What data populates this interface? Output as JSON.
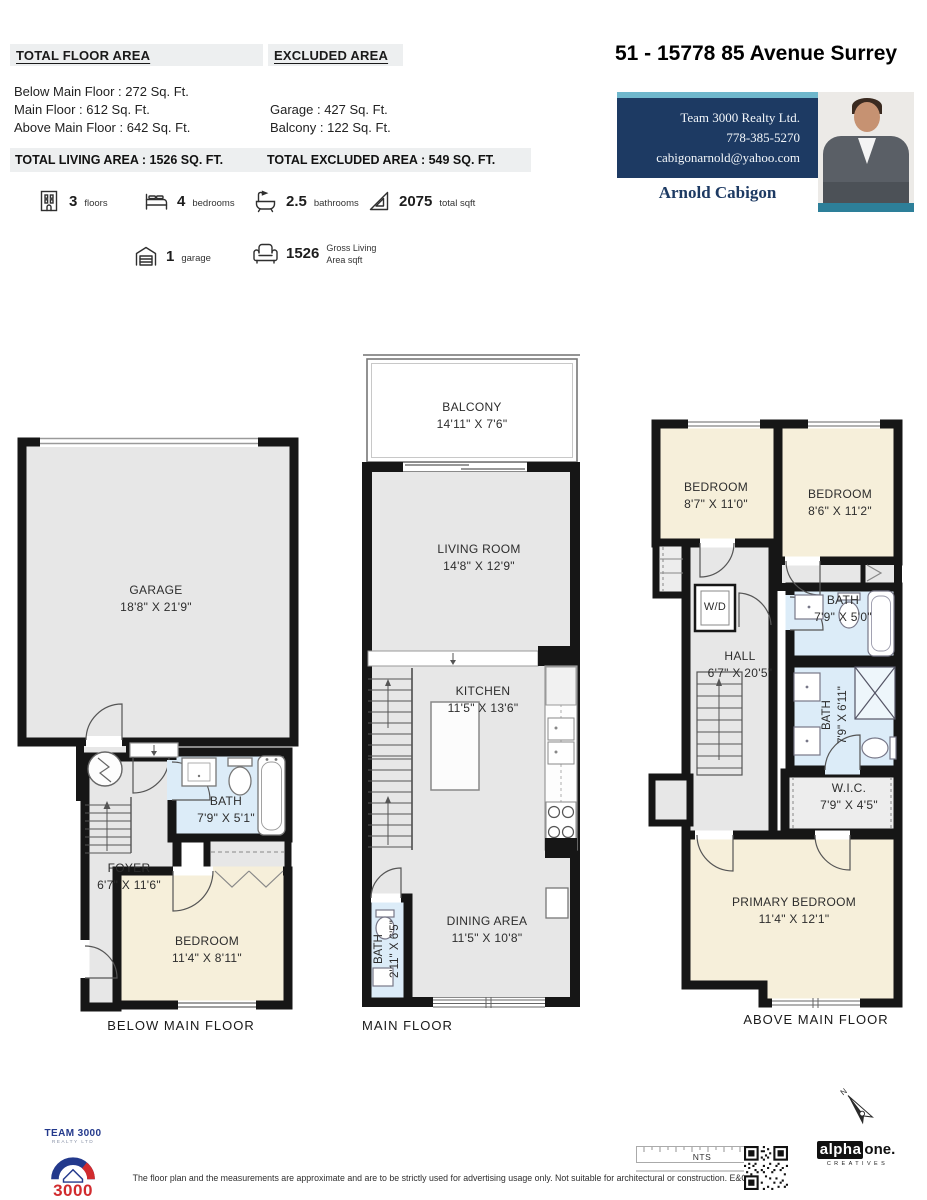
{
  "colors": {
    "wall": "#161616",
    "floor_gray": "#e7e7e7",
    "bath_blue": "#dcecf8",
    "bedroom_beige": "#f6efda",
    "header_gray": "#edeff0",
    "card_navy": "#1d3a63",
    "card_teal": "#6fb7cc",
    "photo_strip_teal": "#2d7f99",
    "brand_blue": "#23398c",
    "brand_red": "#d12b2e"
  },
  "header": {
    "total_floor_area_heading": "TOTAL FLOOR AREA",
    "excluded_area_heading": "EXCLUDED AREA",
    "floor_lines": [
      "Below Main Floor : 272 Sq. Ft.",
      "Main Floor : 612 Sq. Ft.",
      "Above Main Floor : 642 Sq. Ft."
    ],
    "excluded_lines": [
      "Garage : 427 Sq. Ft.",
      "Balcony : 122 Sq. Ft."
    ],
    "total_living": "TOTAL LIVING AREA :  1526 SQ. FT.",
    "total_excluded": "TOTAL EXCLUDED AREA : 549 SQ. FT.",
    "address": "51 - 15778 85 Avenue Surrey"
  },
  "agent": {
    "company": "Team 3000 Realty Ltd.",
    "phone": "778-385-5270",
    "email": "cabigonarnold@yahoo.com",
    "name": "Arnold Cabigon"
  },
  "stats": {
    "floors": {
      "icon": "building-icon",
      "value": "3",
      "label": "floors"
    },
    "bedrooms": {
      "icon": "bed-icon",
      "value": "4",
      "label": "bedrooms"
    },
    "bathrooms": {
      "icon": "bathtub-icon",
      "value": "2.5",
      "label": "bathrooms"
    },
    "total_sqft": {
      "icon": "ruler-triangle-icon",
      "value": "2075",
      "label": "total sqft"
    },
    "garage": {
      "icon": "garage-icon",
      "value": "1",
      "label": "garage"
    },
    "gross_living": {
      "icon": "armchair-icon",
      "value": "1526",
      "label_line1": "Gross Living",
      "label_line2": "Area sqft"
    }
  },
  "floors": {
    "below": {
      "label": "BELOW MAIN FLOOR",
      "rooms": {
        "garage": {
          "name": "GARAGE",
          "dims": "18'8\" X 21'9\""
        },
        "bath": {
          "name": "BATH",
          "dims": "7'9\" X 5'1\""
        },
        "foyer": {
          "name": "FOYER",
          "dims": "6'7\" X 11'6\""
        },
        "bedroom": {
          "name": "BEDROOM",
          "dims": "11'4\" X 8'11\""
        }
      }
    },
    "main": {
      "label": "MAIN FLOOR",
      "rooms": {
        "balcony": {
          "name": "BALCONY",
          "dims": "14'11\" X 7'6\""
        },
        "living": {
          "name": "LIVING ROOM",
          "dims": "14'8\" X 12'9\""
        },
        "kitchen": {
          "name": "KITCHEN",
          "dims": "11'5\" X 13'6\""
        },
        "dining": {
          "name": "DINING AREA",
          "dims": "11'5\" X 10'8\""
        },
        "bath": {
          "name": "BATH",
          "dims": "2'11\" X 6'5\""
        }
      }
    },
    "above": {
      "label": "ABOVE MAIN FLOOR",
      "rooms": {
        "bedroom1": {
          "name": "BEDROOM",
          "dims": "8'7\" X 11'0\""
        },
        "bedroom2": {
          "name": "BEDROOM",
          "dims": "8'6\" X 11'2\""
        },
        "wd": {
          "name": "W/D"
        },
        "hall": {
          "name": "HALL",
          "dims": "6'7\" X 20'5\""
        },
        "bath_upper": {
          "name": "BATH",
          "dims": "7'9\" X 5'0\""
        },
        "bath_lower": {
          "name": "BATH",
          "dims": "7'9\" X 6'11\""
        },
        "wic": {
          "name": "W.I.C.",
          "dims": "7'9\" X 4'5\""
        },
        "primary": {
          "name": "PRIMARY BEDROOM",
          "dims": "11'4\" X 12'1\""
        }
      }
    }
  },
  "footer": {
    "brand_top": "TEAM 3000",
    "brand_sub": "REALTY LTD",
    "brand_number": "3000",
    "disclaimer": "The floor plan and the measurements are approximate and are to be strictly used for advertising usage only. Not suitable for architectural or construction. E&O Insured.",
    "scale_label": "NTS",
    "credit_alpha": "alpha",
    "credit_one": "one.",
    "credit_sub": "CREATIVES",
    "north_label": "N"
  }
}
